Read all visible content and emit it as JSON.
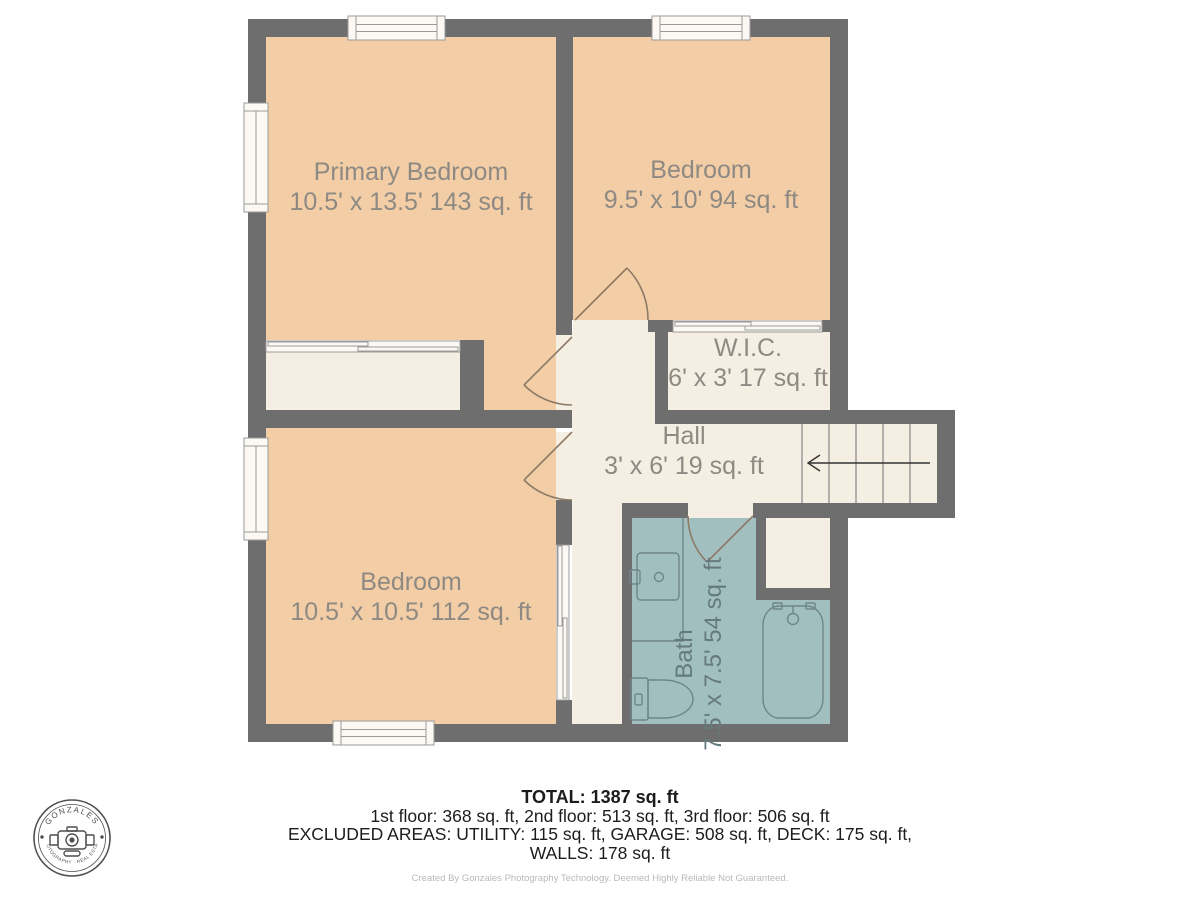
{
  "plan": {
    "rooms": [
      {
        "name": "Primary Bedroom",
        "dims": "10.5' x 13.5' 143 sq. ft"
      },
      {
        "name": "Bedroom",
        "dims": "9.5' x 10' 94 sq. ft"
      },
      {
        "name": "W.I.C.",
        "dims": "6' x 3' 17 sq. ft"
      },
      {
        "name": "Hall",
        "dims": "3' x 6' 19 sq. ft"
      },
      {
        "name": "Bedroom",
        "dims": "10.5' x 10.5' 112 sq. ft"
      },
      {
        "name": "Bath",
        "dims": "7.5' x 7.5' 54 sq. ft"
      }
    ]
  },
  "summary": {
    "total": "TOTAL: 1387 sq. ft",
    "floors": "1st floor: 368 sq. ft, 2nd floor: 513 sq. ft, 3rd floor: 506 sq. ft",
    "excluded": "EXCLUDED AREAS: UTILITY: 115 sq. ft, GARAGE: 508 sq. ft, DECK: 175 sq. ft,",
    "walls": "WALLS: 178 sq. ft",
    "credit": "Created By Gonzales Photography Technology. Deemed Highly Reliable Not Guaranteed."
  },
  "logo": {
    "top_text": "GONZALES",
    "bottom_text": "PHOTOGRAPHY · REAL ESTATE"
  },
  "colors": {
    "wall": "#6e6e6e",
    "bedroom": "#f2cda6",
    "hall": "#f5eee3",
    "bath": "#a2bfc0",
    "window": "#fcf9f4",
    "label": "#8e8a83",
    "bath-label": "#657a7c",
    "door": "#8d7b66",
    "fixture": "#6f8688",
    "tread": "#9b9b9b",
    "arrow": "#333333",
    "footer-text": "#1c1c1c",
    "credit-text": "#b9b9b9",
    "logo-ink": "#4f4f4f"
  }
}
